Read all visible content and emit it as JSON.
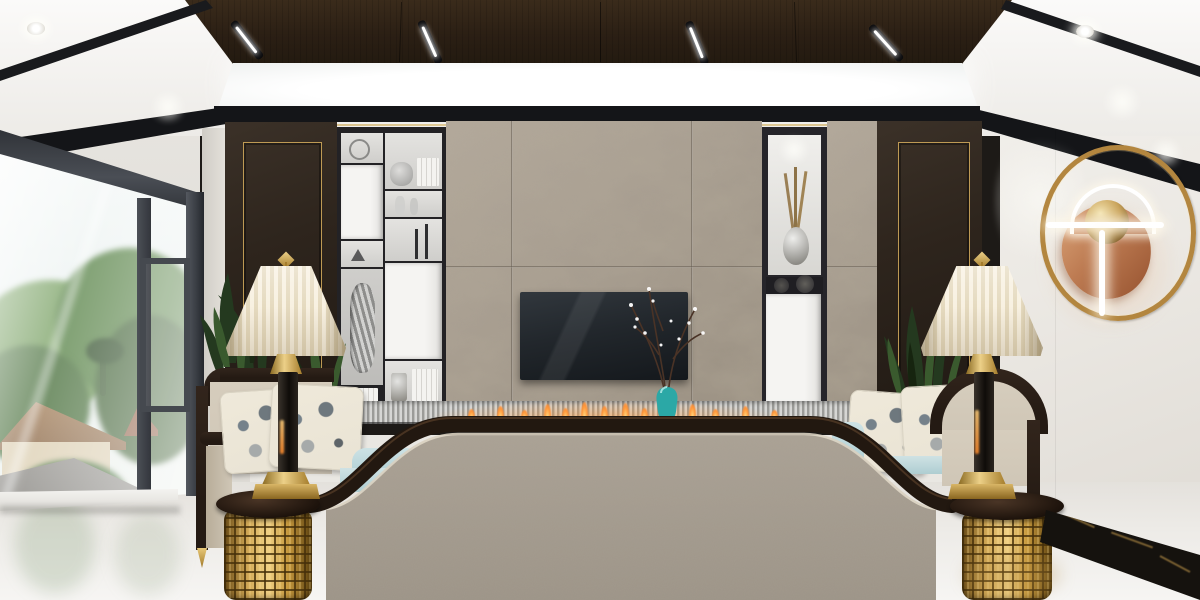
{
  "meta": {
    "domain": "natural-image",
    "subject": "photorealistic-interior-render",
    "room": "modern-chinese-living-room",
    "view": "one-point-perspective-toward-tv-wall"
  },
  "colors": {
    "ceilWood": "#3a2b1b",
    "trimBlack": "#141518",
    "wallLeft": "#e9e7e2",
    "wallRight": "#ece9e4",
    "panelDark": "#2e251d",
    "goldTrim": "#c9a254",
    "concrete": "#a79d90",
    "shelfFrame": "#232225",
    "fabricSofa": "#a59c8f",
    "woodTrim": "#241a13",
    "chairFabric": "#cfc6b6",
    "pillowBase": "#e9e3d4",
    "blueCushion": "#b7d4d8",
    "lampShade": "#f2e9d6",
    "gold": "#c89a3e",
    "copper": "#bd7b52",
    "plantGreen": "#2f4526",
    "teal": "#2ba8a6",
    "flame": "#ff9335",
    "floor": "#edebe7",
    "baseboard": "#15120e",
    "glassTrees": "#5d8148",
    "frameDark": "#3c4045"
  },
  "scene": {
    "objects": [
      "coffered-dark-wood-ceiling-panel",
      "four-slanted-linear-ceiling-lights",
      "white-cove-light-band",
      "recessed-downlights",
      "large-window-with-garden-view",
      "trees-palm-and-rooftops-outside",
      "concrete-tile-tv-feature-wall",
      "wall-mounted-tv",
      "black-display-shelving-with-white-doors",
      "silver-vases-books-candlesticks-decor",
      "niche-with-silver-vase-and-dried-reeds",
      "dark-wood-wall-panels-with-gold-trim",
      "linear-ethanol-fireplace-with-flames",
      "teal-vase-with-white-blossom-branches",
      "ring-and-copper-disc-wall-sconce",
      "two-cream-bell-table-lamps",
      "two-gold-fretwork-drum-side-tables",
      "two-armchairs-with-floral-pillows",
      "light-blue-bolster-cushions",
      "wide-sofa-back-with-ogee-wood-trim",
      "potted-green-plants",
      "polished-marble-floor",
      "black-gold-marble-baseboard"
    ]
  }
}
